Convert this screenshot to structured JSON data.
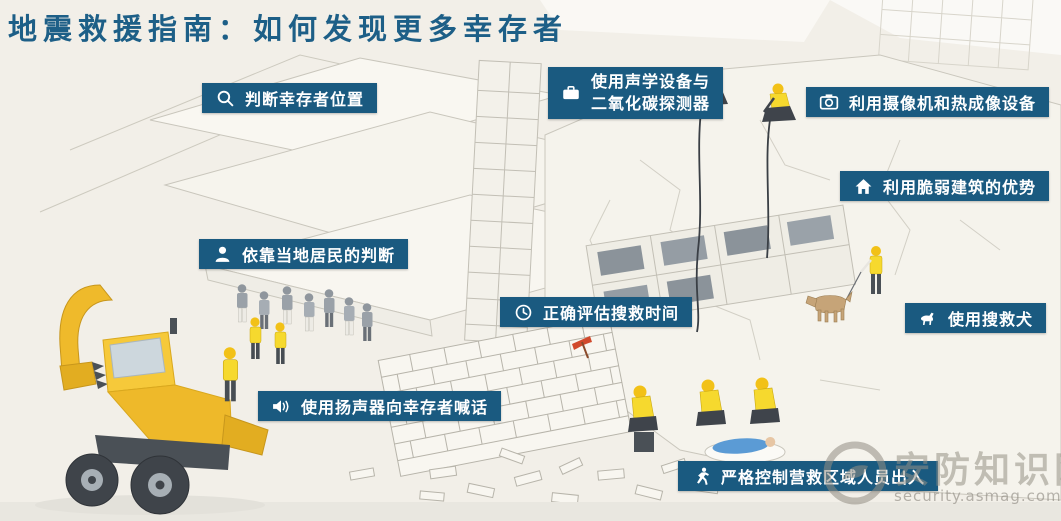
{
  "title": "地震救援指南：如何发现更多幸存者",
  "callouts": [
    {
      "icon": "magnifier-icon",
      "label": "判断幸存者位置"
    },
    {
      "icon": "detector-device-icon",
      "lines": [
        "使用声学设备与",
        "二氧化碳探测器"
      ]
    },
    {
      "icon": "camera-icon",
      "label": "利用摄像机和热成像设备"
    },
    {
      "icon": "house-icon",
      "label": "利用脆弱建筑的优势"
    },
    {
      "icon": "person-icon",
      "label": "依靠当地居民的判断"
    },
    {
      "icon": "clock-icon",
      "label": "正确评估搜救时间"
    },
    {
      "icon": "dog-icon",
      "label": "使用搜救犬"
    },
    {
      "icon": "loudspeaker-icon",
      "label": "使用扬声器向幸存者喊话"
    },
    {
      "icon": "runner-icon",
      "label": "严格控制营救区域人员出入"
    }
  ],
  "watermark": {
    "site_name": "安防知识网",
    "site_url": "security.asmag.com.cn"
  },
  "colors": {
    "badge_background": "#1A5A80",
    "badge_text": "#FFFFFF",
    "title_text": "#1D5F87",
    "page_background": "#F2EFE8",
    "excavator_yellow": "#F2C230",
    "vest_yellow": "#F6D92E",
    "helmet_yellow": "#F2C117",
    "survivor_blue": "#5B9BD5",
    "dog_tan": "#C6A478",
    "pick_red": "#D1492C",
    "sketch_line": "#C9C6BC"
  }
}
